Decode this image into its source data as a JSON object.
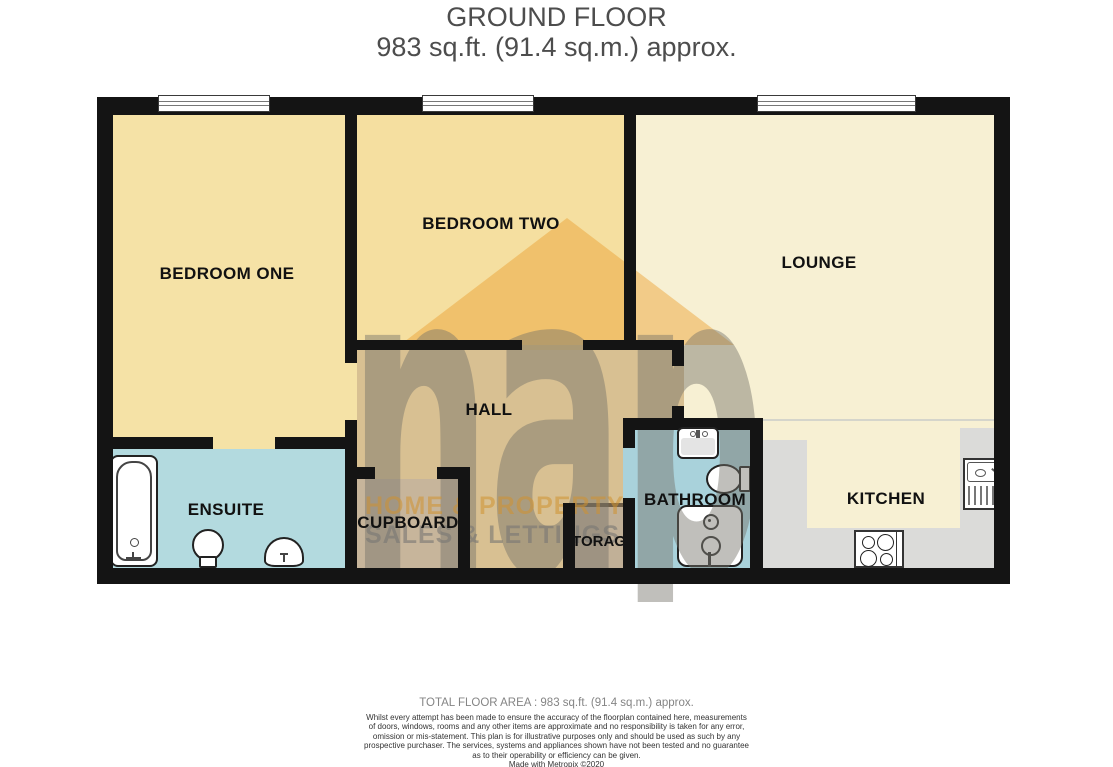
{
  "title": {
    "line1": "GROUND FLOOR",
    "line2": "983 sq.ft. (91.4 sq.m.) approx."
  },
  "rooms": {
    "bedroom_one": {
      "label": "BEDROOM ONE",
      "floor_color": "#F5E2A6"
    },
    "bedroom_two": {
      "label": "BEDROOM TWO",
      "floor_color": "#F5DFA0"
    },
    "lounge": {
      "label": "LOUNGE",
      "floor_color": "#F7F0D3"
    },
    "hall": {
      "label": "HALL",
      "floor_color": "#F1E6C1"
    },
    "ensuite": {
      "label": "ENSUITE",
      "floor_color": "#B3DADF"
    },
    "cupboard": {
      "label": "CUPBOARD",
      "floor_color": "#D5D3CF"
    },
    "storage": {
      "label": "STORAGE",
      "floor_color": "#CBCBC9"
    },
    "bathroom": {
      "label": "BATHROOM",
      "floor_color": "#A9D2DB"
    },
    "kitchen": {
      "label": "KITCHEN",
      "floor_color": "#F7F0D3",
      "counter_color": "#DBDBD9"
    }
  },
  "watermark": {
    "word": "nap",
    "line1": "HOME & PROPERTY",
    "line2": "SALES & LETTINGS"
  },
  "palette": {
    "wall": "#141414",
    "window_trim": "#3a3a3a",
    "watermark_roof": "#EC9E2C",
    "watermark_gray": "#737068",
    "watermark_orange_text": "#D09230",
    "title_text": "#4d4d4d"
  },
  "footer": {
    "total_area": "TOTAL FLOOR AREA : 983 sq.ft. (91.4 sq.m.) approx.",
    "disclaimer": "Whilst every attempt has been made to ensure the accuracy of the floorplan contained here, measurements\nof doors, windows, rooms and any other items are approximate and no responsibility is taken for any error,\nomission or mis-statement. This plan is for illustrative purposes only and should be used as such by any\nprospective purchaser. The services, systems and appliances shown have not been tested and no guarantee\nas to their operability or efficiency can be given.",
    "credit": "Made with Metropix ©2020"
  }
}
